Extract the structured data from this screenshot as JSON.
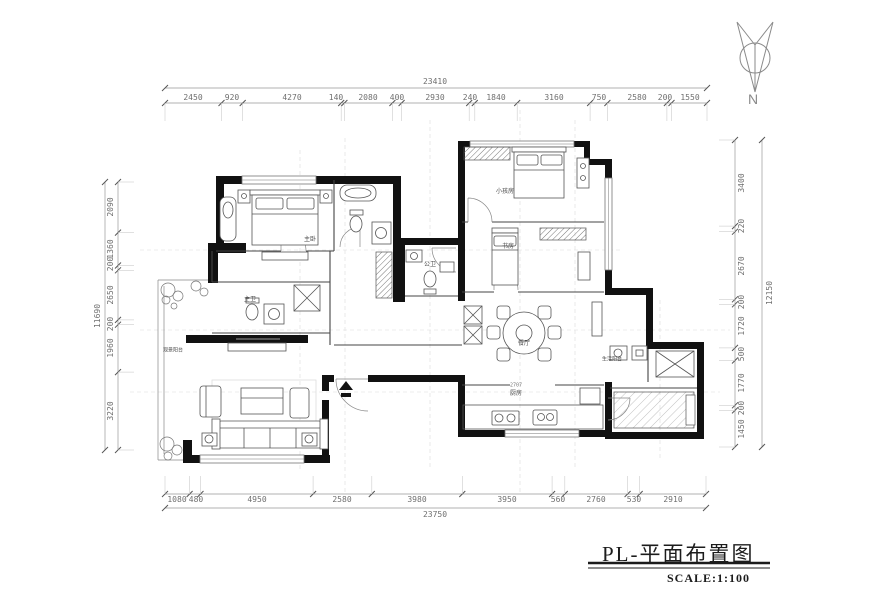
{
  "title_block": {
    "title": "PL-平面布置图",
    "scale": "SCALE:1:100"
  },
  "north_label": "N",
  "dimensions": {
    "top": {
      "total": "23410",
      "segments": [
        "2450",
        "920",
        "4270",
        "140",
        "2080",
        "400",
        "2930",
        "240",
        "1840",
        "3160",
        "750",
        "2580",
        "200",
        "1550"
      ]
    },
    "bottom": {
      "total": "23750",
      "segments": [
        "1080",
        "480",
        "4950",
        "2580",
        "3980",
        "3950",
        "560",
        "2760",
        "530",
        "2910"
      ]
    },
    "left": {
      "total": "11690",
      "segments": [
        "2090",
        "1360",
        "200",
        "2650",
        "200",
        "1960",
        "3220"
      ]
    },
    "right": {
      "total": "12150",
      "segments": [
        "3400",
        "220",
        "2670",
        "200",
        "1720",
        "500",
        "1770",
        "200",
        "1450"
      ]
    },
    "interior": {
      "kitchen_counter": "2707"
    }
  },
  "rooms": {
    "master_bedroom": "主卧",
    "master_bath": "主卫",
    "guest_bath": "公卫",
    "kids_room": "小孩房",
    "study": "书房",
    "dining": "餐厅",
    "kitchen": "厨房",
    "view_balcony": "观景阳台",
    "service_balcony": "生活阳台"
  },
  "colors": {
    "wall": "#111111",
    "line": "#555555",
    "dim": "#6f6f6f"
  }
}
